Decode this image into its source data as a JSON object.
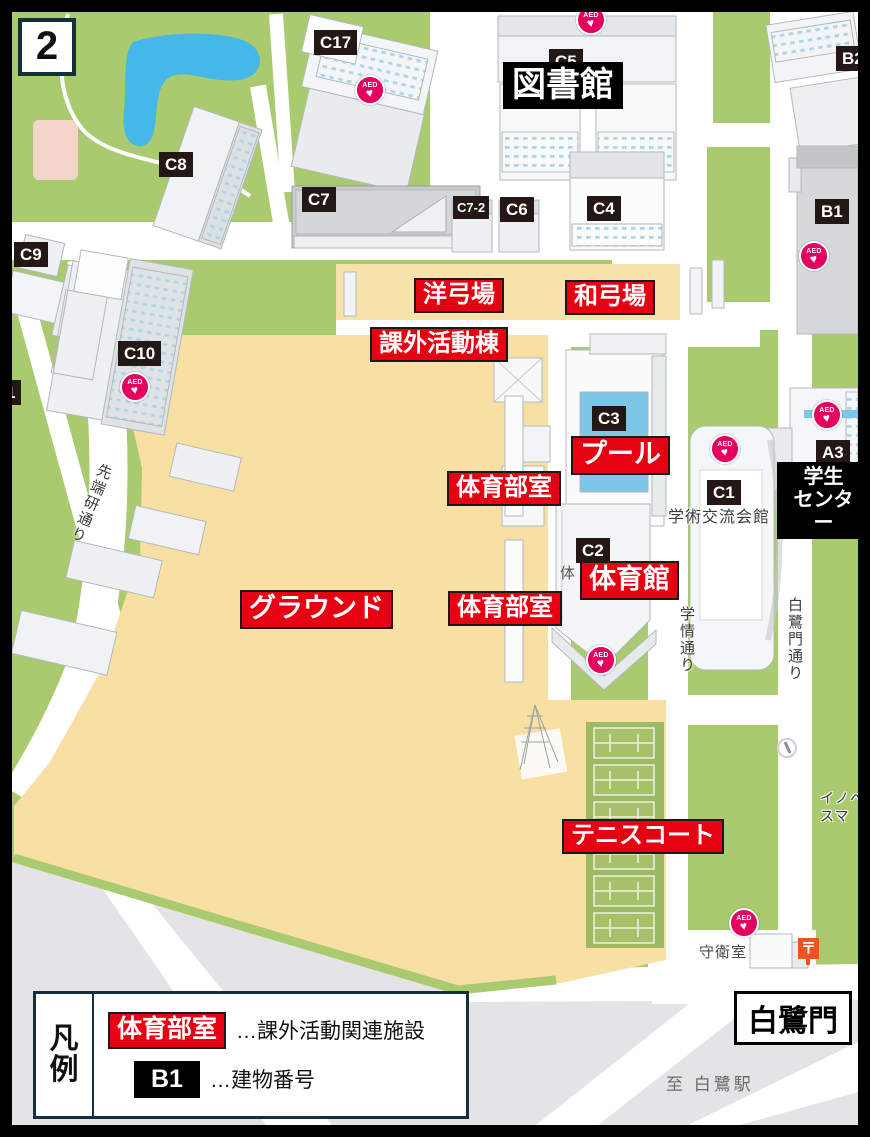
{
  "colors": {
    "frame": "#000000",
    "grass": "#a9ca6e",
    "ground_tan": "#f8dfa4",
    "road_white": "#ffffff",
    "pond_blue": "#45b7e8",
    "pool_blue": "#7cc7e8",
    "offcampus_gray": "#e4e4e6",
    "facility_label_red": "#e60012",
    "building_label_dark": "#231815",
    "aed_pink": "#e4005f",
    "legend_border_navy": "#14303f",
    "post_orange": "#ea5520"
  },
  "map": {
    "page_badge": "2",
    "building_numbers": [
      {
        "text": "C17",
        "x": 314,
        "y": 30
      },
      {
        "text": "C5",
        "x": 549,
        "y": 49
      },
      {
        "text": "B2",
        "x": 836,
        "y": 46
      },
      {
        "text": "C8",
        "x": 159,
        "y": 152
      },
      {
        "text": "C9",
        "x": 14,
        "y": 242
      },
      {
        "text": "C7",
        "x": 302,
        "y": 187
      },
      {
        "text": "C7-2",
        "x": 453,
        "y": 196,
        "small": true
      },
      {
        "text": "C6",
        "x": 500,
        "y": 197
      },
      {
        "text": "C4",
        "x": 587,
        "y": 196
      },
      {
        "text": "B1",
        "x": 815,
        "y": 199
      },
      {
        "text": "C10",
        "x": 118,
        "y": 341
      },
      {
        "text": "1",
        "x": 0,
        "y": 380
      },
      {
        "text": "C3",
        "x": 592,
        "y": 406
      },
      {
        "text": "C1",
        "x": 707,
        "y": 480
      },
      {
        "text": "C2",
        "x": 576,
        "y": 538
      },
      {
        "text": "A3",
        "x": 816,
        "y": 440
      }
    ],
    "facility_labels": [
      {
        "text": "洋弓場",
        "x": 414,
        "y": 278,
        "fs": 24
      },
      {
        "text": "和弓場",
        "x": 565,
        "y": 280,
        "fs": 24
      },
      {
        "text": "課外活動棟",
        "x": 370,
        "y": 327,
        "fs": 24
      },
      {
        "text": "プール",
        "x": 571,
        "y": 436,
        "fs": 27
      },
      {
        "text": "体育部室",
        "x": 447,
        "y": 471,
        "fs": 24
      },
      {
        "text": "体育館",
        "x": 580,
        "y": 561,
        "fs": 27
      },
      {
        "text": "グラウンド",
        "x": 240,
        "y": 590,
        "fs": 27
      },
      {
        "text": "体育部室",
        "x": 448,
        "y": 591,
        "fs": 24
      },
      {
        "text": "テニスコート",
        "x": 562,
        "y": 819,
        "fs": 24
      }
    ],
    "place_labels": [
      {
        "text": "図書館",
        "x": 503,
        "y": 62,
        "fs": 34
      },
      {
        "text": "学生\nセンター",
        "x": 777,
        "y": 462,
        "fs": 20,
        "center": true
      }
    ],
    "gate_label": {
      "text": "白鷺門",
      "x": 734,
      "y": 991,
      "fs": 30
    },
    "road_names": [
      {
        "text": "先端研通り",
        "x": 96,
        "y": 464,
        "rot": 22
      },
      {
        "text": "学情通り",
        "x": 676,
        "y": 606,
        "rot": 0
      },
      {
        "text": "白鷺門通り",
        "x": 784,
        "y": 597,
        "rot": 0
      }
    ],
    "small_texts": [
      {
        "text": "学術交流会館",
        "x": 668,
        "y": 508,
        "fs": 16,
        "color": "#3a3a3a",
        "halo": true
      },
      {
        "text": "守衛室",
        "x": 699,
        "y": 944,
        "fs": 15,
        "color": "#4a4a4a",
        "halo": true
      },
      {
        "text": "至 白鷺駅",
        "x": 666,
        "y": 1074,
        "fs": 17,
        "color": "#6a6a6a",
        "ls": 3
      },
      {
        "text": "体",
        "x": 560,
        "y": 565,
        "fs": 15,
        "color": "#555555"
      },
      {
        "text": "イノベ\n スマ",
        "x": 820,
        "y": 790,
        "fs": 14,
        "color": "#3a3a3a",
        "halo": true
      }
    ],
    "aed": {
      "label": "AED",
      "heart": "♥",
      "positions": [
        [
          589,
          18
        ],
        [
          368,
          88
        ],
        [
          812,
          254
        ],
        [
          133,
          385
        ],
        [
          825,
          413
        ],
        [
          723,
          447
        ],
        [
          599,
          658
        ],
        [
          742,
          921
        ]
      ]
    },
    "post_office": {
      "symbol": "〒",
      "x": 798,
      "y": 938
    },
    "legend": {
      "title": "凡例",
      "rows": [
        {
          "style": "red",
          "label": "体育部室",
          "desc": "…課外活動関連施設"
        },
        {
          "style": "black",
          "label": "B1",
          "desc": "…建物番号"
        }
      ]
    }
  }
}
